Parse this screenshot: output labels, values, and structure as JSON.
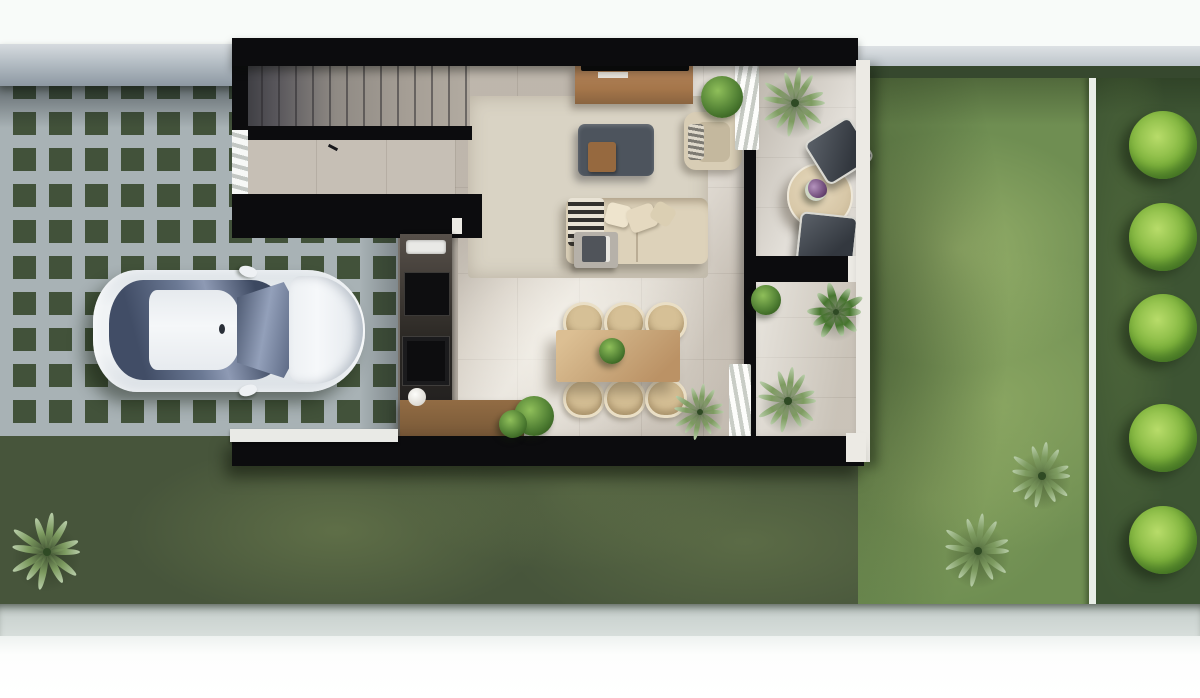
{
  "meta": {
    "scene_type": "top-down 3D architectural render",
    "description": "Single-family modern house floor plan seen from above, with grass-grid driveway, parked white sedan, open-plan interior, east terrace and rear lawn with tree border"
  },
  "colors": {
    "sky": "#f8fbf9",
    "lawn_base": "#47553b",
    "lawn_main": "#6f8e52",
    "lawn_strip": "#3d5433",
    "hedge": "#36482e",
    "path_white": "#e9eee7",
    "paver_gray": "#a8b2b5",
    "paver_grass": "#42523a",
    "house_black": "#0c0c0e",
    "tile_main": "#d3ccc2",
    "tile_entry": "#c6bfb5",
    "tile_kitchen": "#b5aea4",
    "wood_console": "#a5764a",
    "wood_island": "#82603c",
    "wood_table": "#cbaa7e",
    "rattan": "#d6c096",
    "ottoman": "#4d545d",
    "sofa": "#ddd2ba",
    "rug": "#d9d3c4",
    "patio_floor": "#d0cac1",
    "patio_table": "#d7c7a7",
    "curtain_white": "#fdfdfb",
    "car_body": "#f0f3f5",
    "car_glass": "#6b7994",
    "tree_bright": "#7eb33c",
    "palm_green": "#7d9b60",
    "agave_green": "#46752e",
    "bush_green": "#4e7d32",
    "flower_purple": "#6e4a78",
    "white_trim": "#eceae4"
  },
  "site": {
    "areas": [
      "grass-grid-driveway",
      "carport",
      "front-lawn",
      "rear-lawn",
      "tree-border-strip",
      "garden-path",
      "street-sidewalk",
      "boundary-walls"
    ]
  },
  "house": {
    "rooms": [
      "staircase",
      "entry-hall",
      "kitchen",
      "dining-area",
      "living-room",
      "terrace-patio",
      "side-courtyard"
    ],
    "furniture": {
      "living_room": [
        "tv-console",
        "tv",
        "ottoman",
        "wood-tray",
        "armchair",
        "sofa",
        "throw-blanket",
        "pillows",
        "side-table",
        "books",
        "rug"
      ],
      "kitchen": [
        "counter-run",
        "sink",
        "cooktop",
        "oven",
        "island"
      ],
      "dining": {
        "table": "rectangular-wood",
        "seat_count": 6,
        "centerpiece": "green-plant"
      },
      "terrace": [
        "round-table",
        "flower-vase",
        "lounge-chair",
        "lounge-chair"
      ]
    }
  },
  "vehicle": {
    "type": "sedan",
    "color": "white",
    "orientation": "facing-east",
    "location": "grass-grid carport"
  },
  "vegetation": {
    "border_trees": {
      "x": 1163,
      "diameter": 68,
      "ys": [
        145,
        237,
        328,
        438,
        540
      ]
    },
    "plants": [
      {
        "kind": "palm",
        "x": 47,
        "y": 552,
        "r": 40
      },
      {
        "kind": "palm",
        "x": 978,
        "y": 551,
        "r": 38
      },
      {
        "kind": "palm",
        "x": 1042,
        "y": 476,
        "r": 34
      },
      {
        "kind": "palm",
        "x": 795,
        "y": 103,
        "r": 36
      },
      {
        "kind": "palm",
        "x": 788,
        "y": 401,
        "r": 34
      },
      {
        "kind": "palm",
        "x": 700,
        "y": 412,
        "r": 29
      },
      {
        "kind": "agave",
        "x": 836,
        "y": 312,
        "r": 30
      },
      {
        "kind": "bush",
        "x": 722,
        "y": 97,
        "r": 21
      },
      {
        "kind": "bush",
        "x": 534,
        "y": 416,
        "r": 20
      },
      {
        "kind": "bush",
        "x": 513,
        "y": 424,
        "r": 14
      },
      {
        "kind": "bush",
        "x": 612,
        "y": 351,
        "r": 13
      },
      {
        "kind": "bush",
        "x": 766,
        "y": 300,
        "r": 15
      },
      {
        "kind": "flowers",
        "x": 816,
        "y": 190,
        "r": 11
      }
    ]
  }
}
